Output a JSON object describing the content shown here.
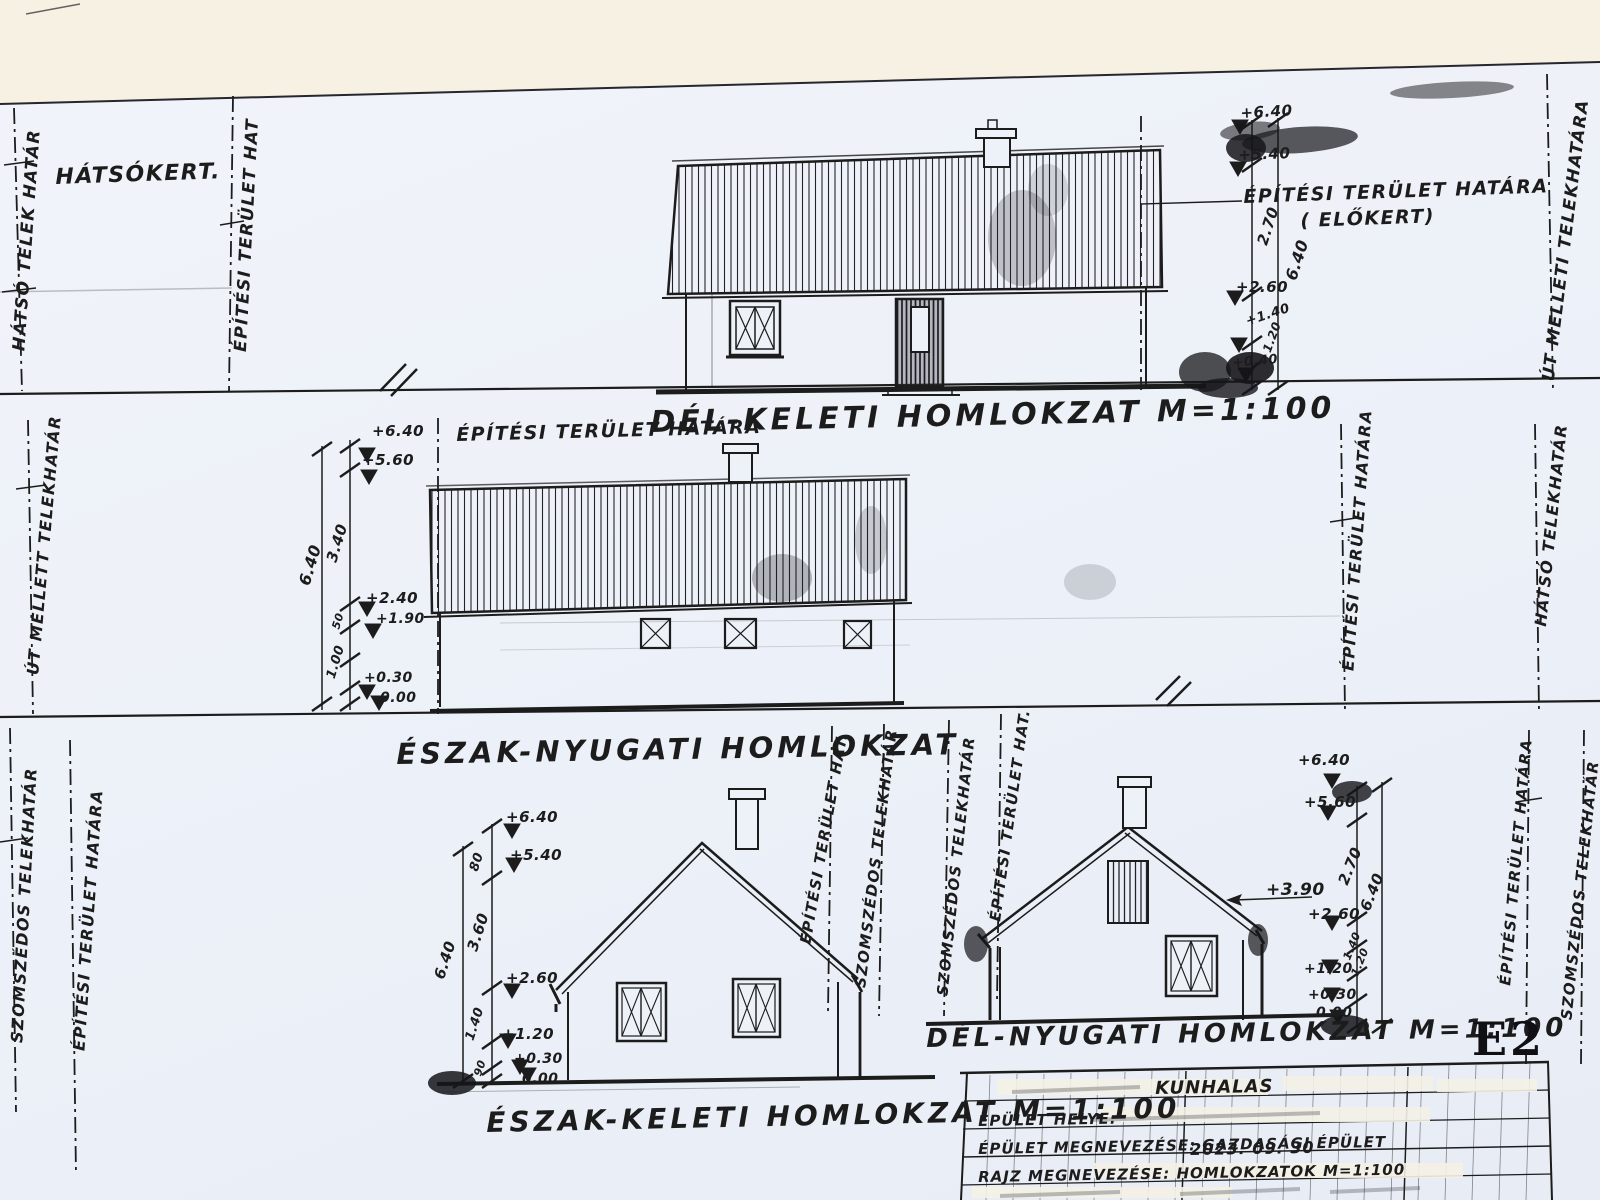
{
  "sheet": {
    "code": "E2"
  },
  "titles": {
    "se": "DÉL-KELETI HOMLOKZAT M=1:100",
    "nw": "ÉSZAK-NYUGATI HOMLOKZAT",
    "ne": "ÉSZAK-KELETI HOMLOKZAT M=1:100",
    "sw": "DÉL-NYUGATI HOMLOKZAT M=1:100"
  },
  "labels": {
    "hatsokert": "HÁTSÓKERT.",
    "ep_ter_hatara": "ÉPÍTÉSI TERÜLET HATÁRA",
    "elokert": "( ELŐKERT)",
    "ep_ter_hatara_mid": "ÉPÍTÉSI TERÜLET HATÁRA"
  },
  "boundaries": {
    "b1_left": "HÁTSÓ TELEK HATÁR",
    "b1_mid": "ÉPÍTÉSI TERÜLET HAT",
    "b1_right": "ÚT MELLETI TELEKHATÁRA",
    "b2_left": "ÚT MELLETT TELEKHATÁR",
    "b2_right_inner": "ÉPÍTÉSI TERÜLET HATÁRA",
    "b2_right_outer": "HÁTSÓ TELEKHATÁR",
    "b3_left_outer": "SZOMSZÉDOS TELEKHATÁR",
    "b3_left_inner": "ÉPÍTÉSI TERÜLET HATÁRA",
    "b3_mid_1": "ÉPÍTÉSI TERÜLET HAT.",
    "b3_mid_2": "SZOMSZÉDOS TELEKHATÁR",
    "b3_mid_3": "SZOMSZÉDOS TELEKHATÁR",
    "b3_mid_4": "ÉPÍTÉSI TERÜLET HAT.",
    "b3_right_inner": "ÉPÍTÉSI TERÜLET HATÁRA",
    "b3_right_outer": "SZOMSZÉDOS TELEKHATÁR"
  },
  "dims": {
    "b1": [
      "+6.40",
      "+5.40",
      "2.70",
      "6.40",
      "+2.60",
      "+1.40",
      "1.20",
      "+0.40"
    ],
    "b2": [
      "+6.40",
      "+5.60",
      "6.40",
      "3.40",
      "+2.40",
      "+1.90",
      "50",
      "1.00",
      "+0.30",
      "0.00"
    ],
    "b3l": [
      "+6.40",
      "80",
      "+5.40",
      "3.60",
      "6.40",
      "+2.60",
      "1.40",
      "+1.20",
      "+0.30",
      "0.00",
      "90"
    ],
    "b3r": [
      "+6.40",
      "+5.60",
      "2.70",
      "6.40",
      "+3.90",
      "+2.60",
      "1.40",
      "1.20",
      "+1.20",
      "+0.30",
      "0.00"
    ]
  },
  "title_block": {
    "city": "KUNHALAS",
    "building_site_label": "ÉPÜLET HELYE:",
    "building_name_label": "ÉPÜLET MEGNEVEZÉSE: GAZDASÁGI ÉPÜLET",
    "date": "2023. 09. 30",
    "drawing_name_label": "RAJZ MEGNEVEZÉSE: HOMLOKZATOK M=1:100"
  },
  "colors": {
    "paper": "#edf1f8",
    "cream": "#f6f1e3",
    "ink": "#1c1c1c"
  }
}
